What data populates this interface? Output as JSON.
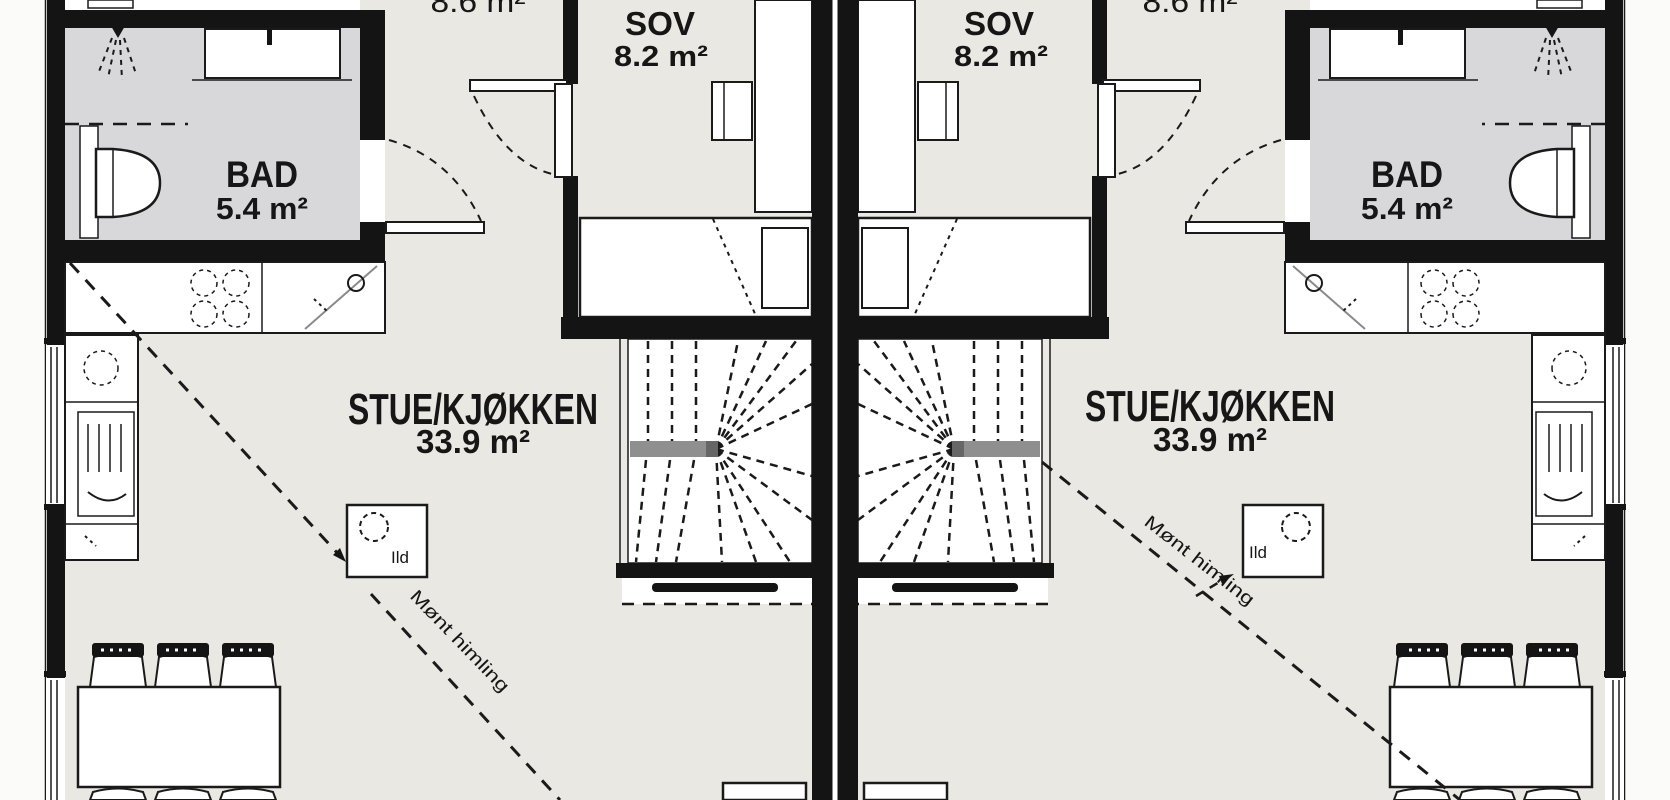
{
  "units": {
    "left": {
      "top_room_area": "8.6 m²",
      "sov": {
        "name": "SOV",
        "area": "8.2 m²"
      },
      "bad": {
        "name": "BAD",
        "area": "5.4 m²"
      },
      "stue": {
        "name": "STUE/KJØKKEN",
        "area": "33.9 m²"
      },
      "fireplace_label": "Ild",
      "ceiling_note": "Mønt himling"
    },
    "right": {
      "top_room_area": "8.6 m²",
      "sov": {
        "name": "SOV",
        "area": "8.2 m²"
      },
      "bad": {
        "name": "BAD",
        "area": "5.4 m²"
      },
      "stue": {
        "name": "STUE/KJØKKEN",
        "area": "33.9 m²"
      },
      "fireplace_label": "Ild",
      "ceiling_note": "Mønt himling"
    }
  },
  "colors": {
    "floor": "#e9e8e3",
    "bathroom_floor": "#d8d8da",
    "wall": "#141414",
    "line": "#1a1a1a",
    "stair_rail": "#8f8f8f",
    "fixture_fill": "#ffffff",
    "exterior": "#fbfbf9"
  }
}
